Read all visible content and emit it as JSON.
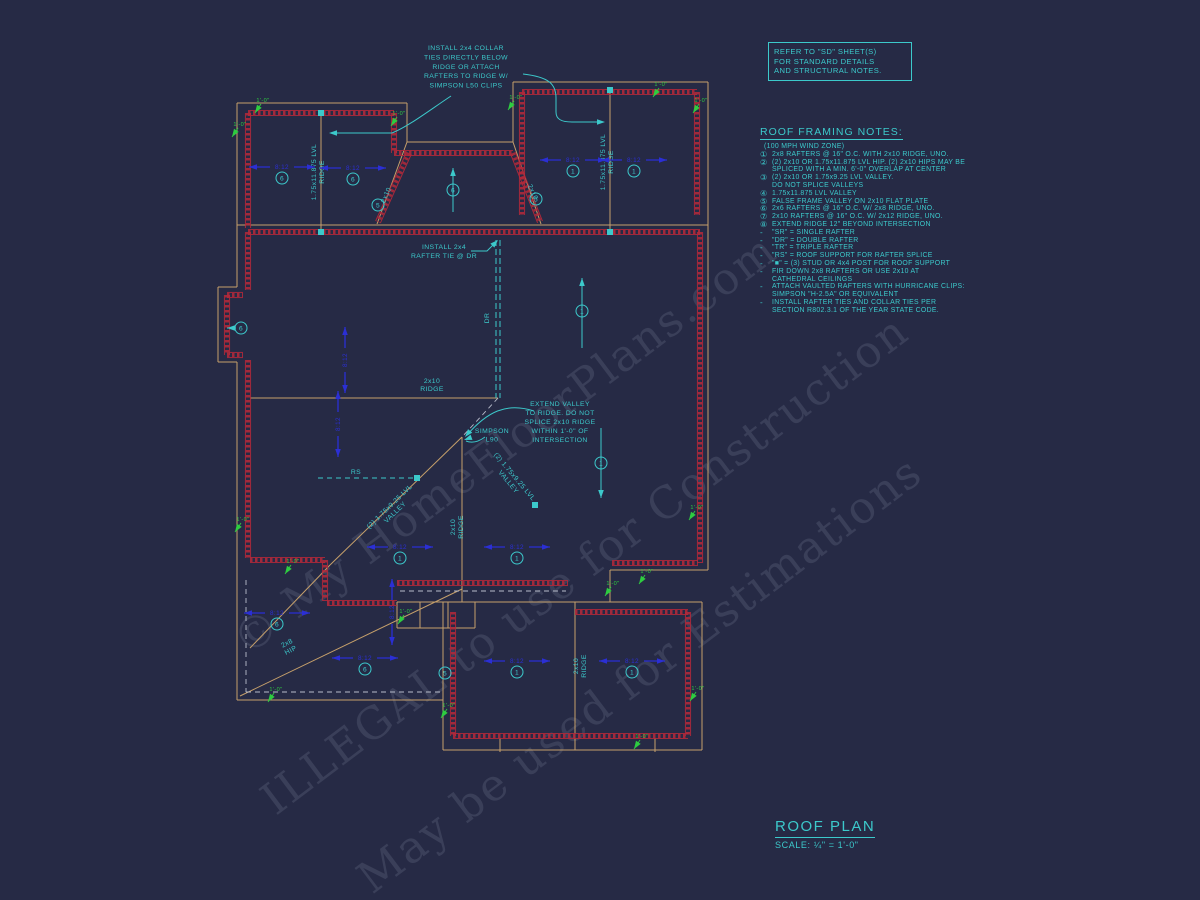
{
  "watermarks": {
    "w1": "© My HomeFloorPlans.com",
    "w2": "ILLEGAL to use for Construction",
    "w3": "May be used for Estimations"
  },
  "refer_box": {
    "line1": "REFER TO \"SD\" SHEET(S)",
    "line2": "FOR STANDARD DETAILS",
    "line3": "AND STRUCTURAL NOTES."
  },
  "framing_notes": {
    "title": "ROOF FRAMING NOTES:",
    "subtitle": "(100 MPH WIND ZONE)",
    "dash": "-",
    "numbered": [
      {
        "sym": "①",
        "lines": [
          "2x8 RAFTERS @ 16\" O.C. WITH 2x10 RIDGE, UNO."
        ]
      },
      {
        "sym": "②",
        "lines": [
          "(2) 2x10 OR 1.75x11.875 LVL HIP. (2) 2x10 HIPS MAY BE",
          "SPLICED WITH A MIN. 6'-0\" OVERLAP AT CENTER"
        ]
      },
      {
        "sym": "③",
        "lines": [
          "(2) 2x10 OR 1.75x9.25 LVL VALLEY.",
          "DO NOT SPLICE VALLEYS"
        ]
      },
      {
        "sym": "④",
        "lines": [
          "1.75x11.875 LVL VALLEY"
        ]
      },
      {
        "sym": "⑤",
        "lines": [
          "FALSE FRAME VALLEY ON 2x10 FLAT PLATE"
        ]
      },
      {
        "sym": "⑥",
        "lines": [
          "2x6 RAFTERS @ 16\" O.C. W/ 2x8 RIDGE, UNO."
        ]
      },
      {
        "sym": "⑦",
        "lines": [
          "2x10 RAFTERS @ 16\" O.C. W/ 2x12 RIDGE, UNO."
        ]
      },
      {
        "sym": "⑧",
        "lines": [
          "EXTEND RIDGE 12\" BEYOND INTERSECTION"
        ]
      }
    ],
    "bullets": [
      {
        "lines": [
          "\"SR\" = SINGLE RAFTER"
        ]
      },
      {
        "lines": [
          "\"DR\" = DOUBLE RAFTER"
        ]
      },
      {
        "lines": [
          "\"TR\" = TRIPLE RAFTER"
        ]
      },
      {
        "lines": [
          "\"RS\" = ROOF SUPPORT FOR RAFTER SPLICE"
        ]
      },
      {
        "lines": [
          "\"■\"  = (3) STUD OR 4x4 POST FOR ROOF SUPPORT"
        ]
      },
      {
        "lines": [
          "FIR DOWN 2x8 RAFTERS OR USE 2x10 AT",
          "CATHEDRAL CEILINGS"
        ]
      },
      {
        "lines": [
          "ATTACH VAULTED RAFTERS WITH HURRICANE CLIPS:",
          "SIMPSON \"H-2.5A\" OR EQUIVALENT"
        ]
      },
      {
        "lines": [
          "INSTALL RAFTER TIES AND COLLAR TIES PER",
          "SECTION R802.3.1 OF THE YEAR STATE CODE."
        ]
      }
    ]
  },
  "title_block": {
    "title": "ROOF PLAN",
    "scale": "SCALE: ¼\" = 1'-0\""
  },
  "plan": {
    "pitch_text": "8:12",
    "dim_text": "1'-0\"",
    "colors": {
      "tan": "#c6a06b",
      "red": "#b2293a",
      "cyan": "#3cc9cb",
      "green": "#2ecc40",
      "blue": "#2b2fd4",
      "gray": "#b8bccb"
    },
    "notes": {
      "collar": [
        "INSTALL 2x4 COLLAR",
        "TIES DIRECTLY BELOW",
        "RIDGE OR ATTACH",
        "RAFTERS TO RIDGE W/",
        "SIMPSON L50 CLIPS"
      ],
      "rafter_tie": [
        "INSTALL 2x4",
        "RAFTER TIE @ DR"
      ],
      "extend_valley": [
        "EXTEND VALLEY",
        "TO RIDGE. DO NOT",
        "SPLICE 2x10 RIDGE",
        "WITHIN 1'-0\" OF",
        "INTERSECTION"
      ],
      "simpson": [
        "SIMPSON",
        "L90"
      ]
    },
    "labels": [
      {
        "t": "1.75x11.875 LVL|RIDGE",
        "x": 316,
        "y": 172,
        "r": -90
      },
      {
        "t": "1.75x11.875 LVL|RIDGE",
        "x": 605,
        "y": 162,
        "r": -90
      },
      {
        "t": "2x10|RIDGE",
        "x": 432,
        "y": 383,
        "r": 0
      },
      {
        "t": "2x10|RIDGE",
        "x": 455,
        "y": 527,
        "r": -90
      },
      {
        "t": "2x10|RIDGE",
        "x": 578,
        "y": 666,
        "r": -90
      },
      {
        "t": "(2) 1.75x9.25 LVL|VALLEY",
        "x": 391,
        "y": 508,
        "r": -44
      },
      {
        "t": "(2) 1.75x9.25 LVL|VALLEY",
        "x": 513,
        "y": 478,
        "r": 50
      },
      {
        "t": "2x8|HIP",
        "x": 288,
        "y": 645,
        "r": -27
      },
      {
        "t": "RS",
        "x": 356,
        "y": 474,
        "r": 0
      },
      {
        "t": "DR",
        "x": 489,
        "y": 318,
        "r": -90
      },
      {
        "t": "2x10",
        "x": 388,
        "y": 196,
        "r": -66
      },
      {
        "t": "2x10",
        "x": 531,
        "y": 193,
        "r": 66
      }
    ],
    "circles": [
      {
        "n": "6",
        "x": 282,
        "y": 178
      },
      {
        "n": "6",
        "x": 353,
        "y": 179
      },
      {
        "n": "1",
        "x": 573,
        "y": 171
      },
      {
        "n": "1",
        "x": 634,
        "y": 171
      },
      {
        "n": "5",
        "x": 378,
        "y": 205
      },
      {
        "n": "5",
        "x": 536,
        "y": 199
      },
      {
        "n": "6",
        "x": 241,
        "y": 328
      },
      {
        "n": "6",
        "x": 453,
        "y": 190
      },
      {
        "n": "1",
        "x": 582,
        "y": 311
      },
      {
        "n": "1",
        "x": 601,
        "y": 463
      },
      {
        "n": "1",
        "x": 400,
        "y": 558
      },
      {
        "n": "1",
        "x": 517,
        "y": 558
      },
      {
        "n": "6",
        "x": 277,
        "y": 624
      },
      {
        "n": "6",
        "x": 365,
        "y": 669
      },
      {
        "n": "5",
        "x": 445,
        "y": 673
      },
      {
        "n": "1",
        "x": 517,
        "y": 672
      },
      {
        "n": "1",
        "x": 632,
        "y": 672
      }
    ],
    "pitches_h": [
      [
        282,
        167
      ],
      [
        353,
        168
      ],
      [
        573,
        160
      ],
      [
        634,
        160
      ],
      [
        400,
        547
      ],
      [
        517,
        547
      ],
      [
        277,
        613
      ],
      [
        365,
        658
      ],
      [
        517,
        661
      ],
      [
        632,
        661
      ]
    ],
    "pitches_v": [
      [
        345,
        360
      ],
      [
        338,
        424
      ],
      [
        392,
        612
      ]
    ],
    "dims": [
      [
        263,
        102
      ],
      [
        240,
        126
      ],
      [
        399,
        115
      ],
      [
        516,
        99
      ],
      [
        661,
        86
      ],
      [
        701,
        102
      ],
      [
        243,
        521
      ],
      [
        293,
        563
      ],
      [
        697,
        509
      ],
      [
        647,
        573
      ],
      [
        276,
        691
      ],
      [
        406,
        613
      ],
      [
        449,
        707
      ],
      [
        698,
        690
      ],
      [
        642,
        738
      ],
      [
        613,
        585
      ]
    ]
  }
}
